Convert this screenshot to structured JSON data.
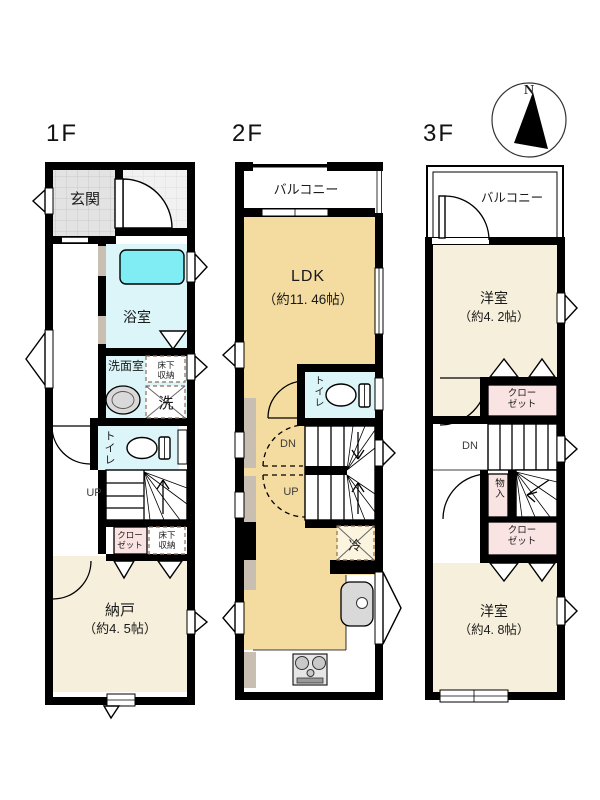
{
  "colors": {
    "wall": "#000000",
    "tile_genkan": "#E3E3E3",
    "tile_grid": "#C9C9C9",
    "tile_porch": "#F1F1F1",
    "porch_grid": "#DEDEDE",
    "bath_room": "#DCF5F8",
    "bathtub": "#7FEDF3",
    "cream_room": "#F6EFDB",
    "ldk_floor": "#F4DCA1",
    "closet_pink": "#F9E3E3",
    "taupe_wall": "#C8BFB2",
    "fridge_bg": "#FBF4DE",
    "fixture_grey": "#D9D9D9",
    "dash_brown": "#8B6F5A",
    "text_dark": "#1A1A1A",
    "stair_text": "#3C3C3C"
  },
  "compass": {
    "north_label": "N"
  },
  "floor1": {
    "label": "1F",
    "entrance": "玄関",
    "bathroom": "浴室",
    "washroom": "洗面室",
    "underfloor_storage_top_line1": "床下",
    "underfloor_storage_top_line2": "収納",
    "laundry": "洗",
    "toilet": "トイレ",
    "stairs_up": "UP",
    "closet_line1": "クロー",
    "closet_line2": "ゼット",
    "underfloor_storage_bottom_line1": "床下",
    "underfloor_storage_bottom_line2": "収納",
    "storeroom_name": "納戸",
    "storeroom_size": "（約4. 5帖）"
  },
  "floor2": {
    "label": "2F",
    "balcony": "バルコニー",
    "ldk_name": "LDK",
    "ldk_size": "（約11. 46帖）",
    "toilet": "トイレ",
    "stairs_down": "DN",
    "stairs_up": "UP",
    "refrigerator": "冷"
  },
  "floor3": {
    "label": "3F",
    "balcony": "バルコニー",
    "bedroom_top_name": "洋室",
    "bedroom_top_size": "（約4. 2帖）",
    "closet_top_line1": "クロー",
    "closet_top_line2": "ゼット",
    "stairs_down": "DN",
    "storage": "物入",
    "closet_bottom_line1": "クロー",
    "closet_bottom_line2": "ゼット",
    "bedroom_bottom_name": "洋室",
    "bedroom_bottom_size": "（約4. 8帖）"
  }
}
